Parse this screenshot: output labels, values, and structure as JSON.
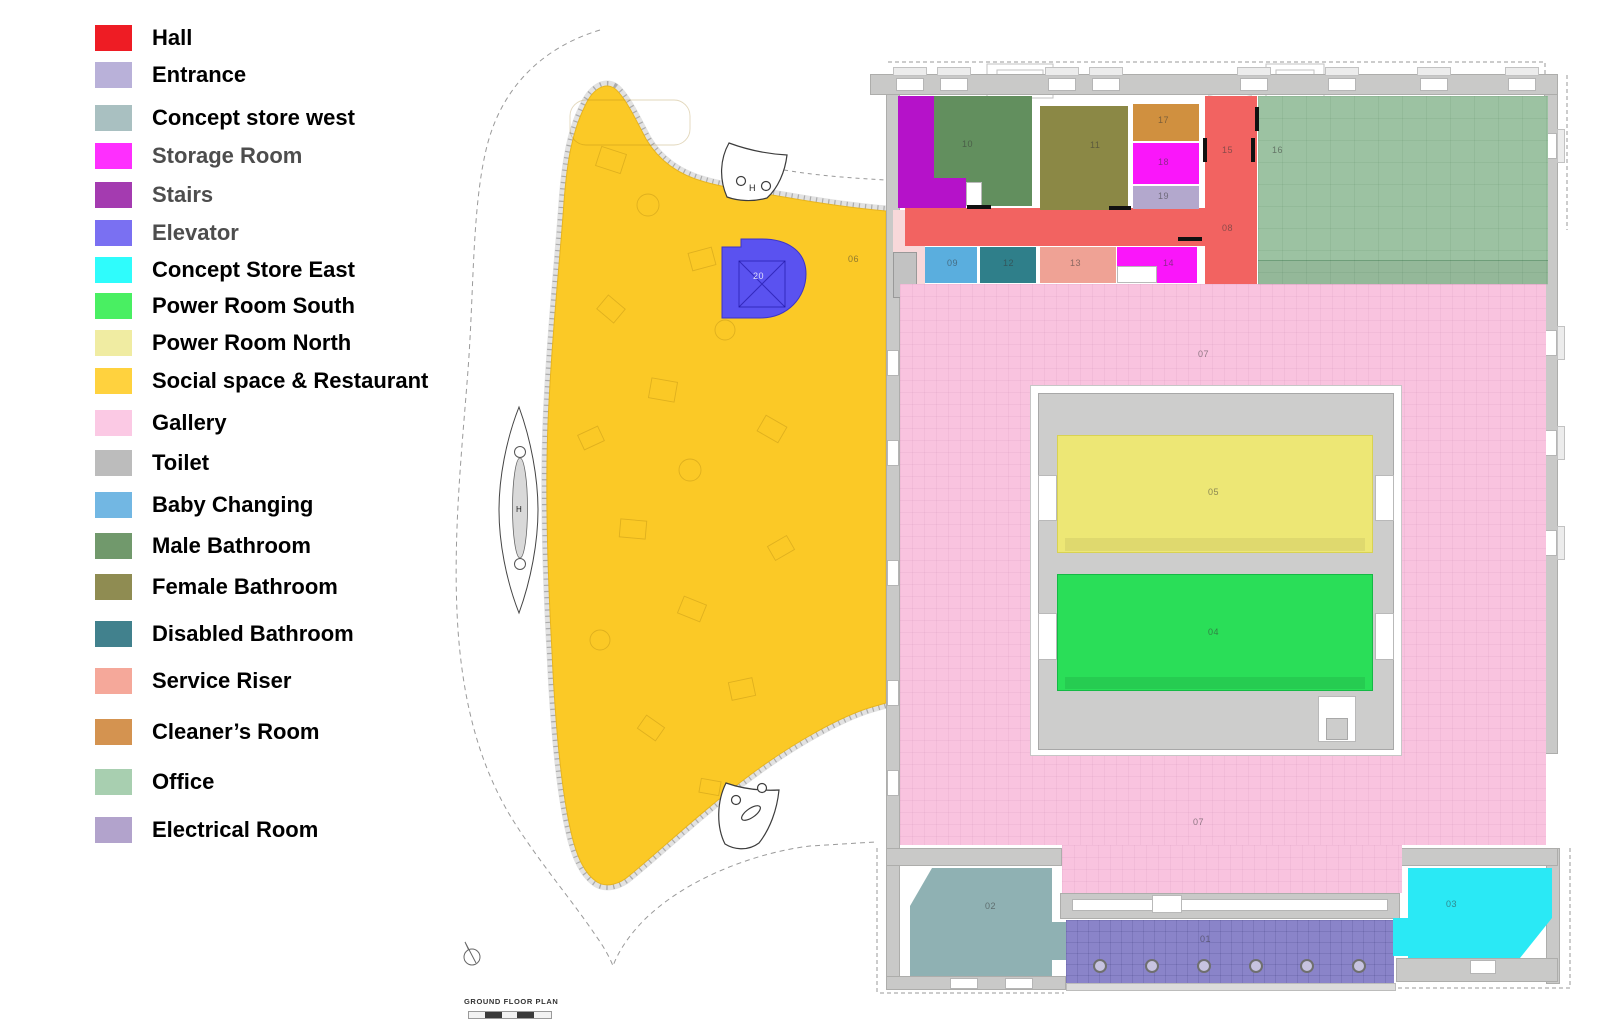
{
  "title": "GROUND FLOOR PLAN",
  "legend": {
    "text_color": "#000000",
    "muted_text_color": "#4d4d4d",
    "items": [
      {
        "label": "Hall",
        "color": "#ee1c24",
        "muted": false
      },
      {
        "label": "Entrance",
        "color": "#b9b1d9",
        "muted": false
      },
      {
        "label": "Concept store west",
        "color": "#a9c0c1",
        "muted": false
      },
      {
        "label": "Storage Room",
        "color": "#fe2ffe",
        "muted": true
      },
      {
        "label": "Stairs",
        "color": "#a43bb0",
        "muted": true
      },
      {
        "label": "Elevator",
        "color": "#7a70f2",
        "muted": true
      },
      {
        "label": "Concept Store East",
        "color": "#2ffcfc",
        "muted": false
      },
      {
        "label": "Power Room South",
        "color": "#49ef62",
        "muted": false
      },
      {
        "label": "Power Room North",
        "color": "#f0eca2",
        "muted": false
      },
      {
        "label": "Social space & Restaurant",
        "color": "#ffd23e",
        "muted": false
      },
      {
        "label": "Gallery",
        "color": "#fbc9e4",
        "muted": false
      },
      {
        "label": "Toilet",
        "color": "#bcbcbc",
        "muted": false
      },
      {
        "label": "Baby Changing",
        "color": "#72b7e3",
        "muted": false
      },
      {
        "label": "Male Bathroom",
        "color": "#71996c",
        "muted": false
      },
      {
        "label": "Female Bathroom",
        "color": "#8f8c52",
        "muted": false
      },
      {
        "label": "Disabled Bathroom",
        "color": "#41818d",
        "muted": false
      },
      {
        "label": "Service Riser",
        "color": "#f5a89a",
        "muted": false
      },
      {
        "label": "Cleaner’s Room",
        "color": "#d49350",
        "muted": false
      },
      {
        "label": "Office",
        "color": "#a8cfb0",
        "muted": false
      },
      {
        "label": "Electrical Room",
        "color": "#b2a3cc",
        "muted": false
      }
    ]
  },
  "plan": {
    "h_marker": "H",
    "rooms": [
      {
        "id": "01",
        "name": "Entrance",
        "color": "#8a84c9"
      },
      {
        "id": "02",
        "name": "Concept store west",
        "color": "#8fb1b3"
      },
      {
        "id": "03",
        "name": "Concept Store East",
        "color": "#2ae9f5"
      },
      {
        "id": "04",
        "name": "Power Room South",
        "color": "#2ade58"
      },
      {
        "id": "05",
        "name": "Power Room North",
        "color": "#ede775"
      },
      {
        "id": "06",
        "name": "Social space & Restaurant",
        "color": "#fbc926"
      },
      {
        "id": "07",
        "name": "Gallery",
        "color": "#f9c3df"
      },
      {
        "id": "08",
        "name": "Hall",
        "color": "#f26361"
      },
      {
        "id": "09",
        "name": "Baby Changing",
        "color": "#5aaede"
      },
      {
        "id": "10",
        "name": "Male Bathroom",
        "color": "#628f5e"
      },
      {
        "id": "11",
        "name": "Female Bathroom",
        "color": "#8b8845"
      },
      {
        "id": "12",
        "name": "Disabled Bathroom",
        "color": "#2f7f8a"
      },
      {
        "id": "13",
        "name": "Service Riser",
        "color": "#efa295"
      },
      {
        "id": "14",
        "name": "Storage Room",
        "color": "#fa16fa"
      },
      {
        "id": "15",
        "name": "Hall",
        "color": "#f26361"
      },
      {
        "id": "16",
        "name": "Office",
        "color": "#9cc2a2"
      },
      {
        "id": "17",
        "name": "Cleaner’s Room",
        "color": "#d0903f"
      },
      {
        "id": "18",
        "name": "Storage Room",
        "color": "#fa16fa"
      },
      {
        "id": "19",
        "name": "Electrical Room",
        "color": "#b3a8cd"
      },
      {
        "id": "20",
        "name": "Elevator",
        "color": "#5a52f0"
      }
    ]
  }
}
